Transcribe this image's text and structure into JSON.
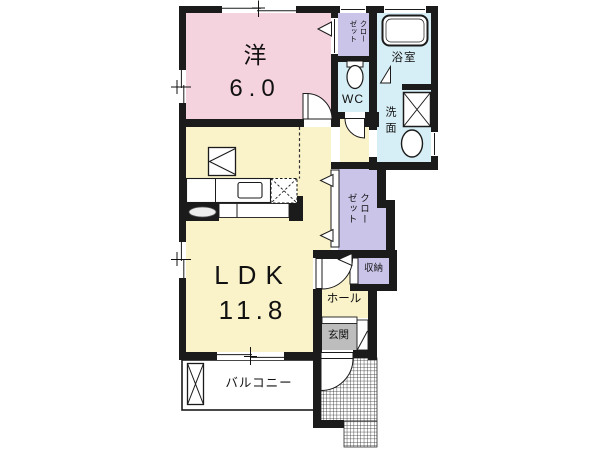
{
  "plan_type": "apartment-floor-plan",
  "rooms": {
    "western": {
      "name": "洋",
      "size": "6.0"
    },
    "ldk": {
      "name": "LDK",
      "size": "11.8"
    },
    "closet_top": {
      "name": "クローゼット"
    },
    "closet_mid": {
      "name": "クローゼット"
    },
    "wc": {
      "name": "WC"
    },
    "bath": {
      "name": "浴室"
    },
    "washroom": {
      "name": "洗面"
    },
    "storage": {
      "name": "収納"
    },
    "hall": {
      "name": "ホール"
    },
    "entrance": {
      "name": "玄関"
    },
    "balcony": {
      "name": "バルコニー"
    }
  },
  "colors": {
    "western_room": "#F5D3DE",
    "ldk": "#FAF3C9",
    "wet_area": "#D6EEF5",
    "closet": "#C9C4E8",
    "entrance": "#BEBDBD",
    "wall": "#1B1B1B",
    "background": "#FFFFFF"
  }
}
